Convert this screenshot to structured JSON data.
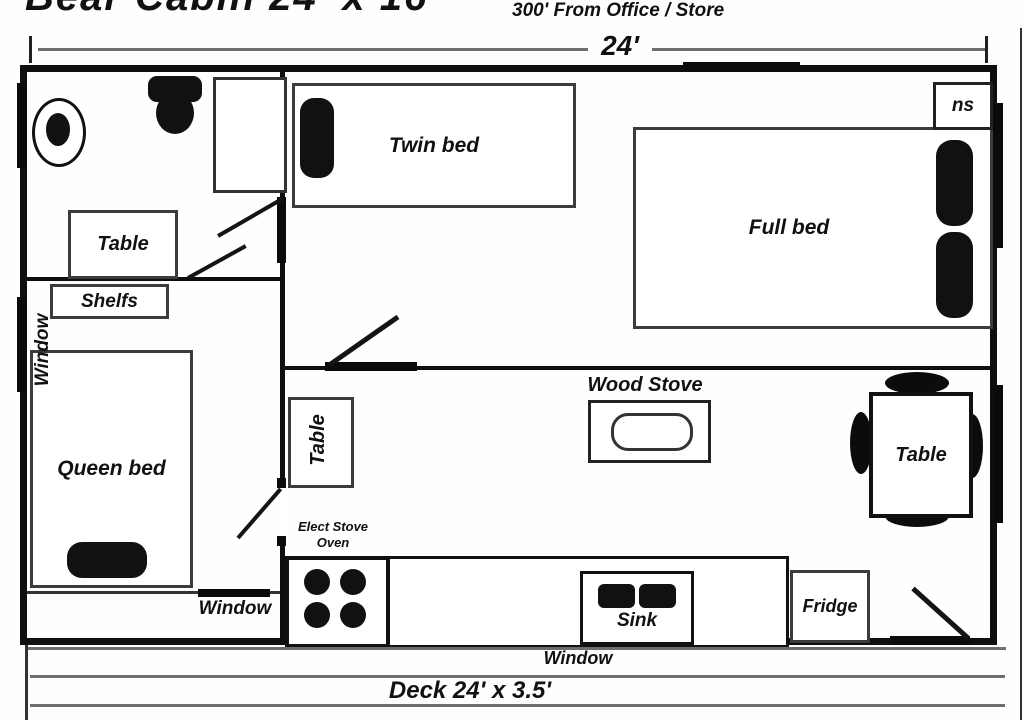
{
  "header": {
    "title": "Bear Cabin 24' x 16'",
    "subtitle": "300' From Office / Store"
  },
  "dimension": {
    "width": "24'"
  },
  "bathroom": {
    "table": "Table"
  },
  "bedroom": {
    "shelfs": "Shelfs",
    "bed": "Queen bed",
    "window_left": "Window",
    "window_bottom": "Window"
  },
  "bunk_room": {
    "twin_bed": "Twin bed",
    "full_bed": "Full bed",
    "nightstand": "ns"
  },
  "living": {
    "side_table": "Table",
    "wood_stove": "Wood Stove",
    "dining_table": "Table"
  },
  "kitchen": {
    "range_line1": "Elect Stove",
    "range_line2": "Oven",
    "sink": "Sink",
    "fridge": "Fridge",
    "window_bottom": "Window"
  },
  "deck": {
    "label": "Deck 24' x 3.5'"
  },
  "colors": {
    "ink": "#111111",
    "line_gray": "#6e6e6e"
  }
}
